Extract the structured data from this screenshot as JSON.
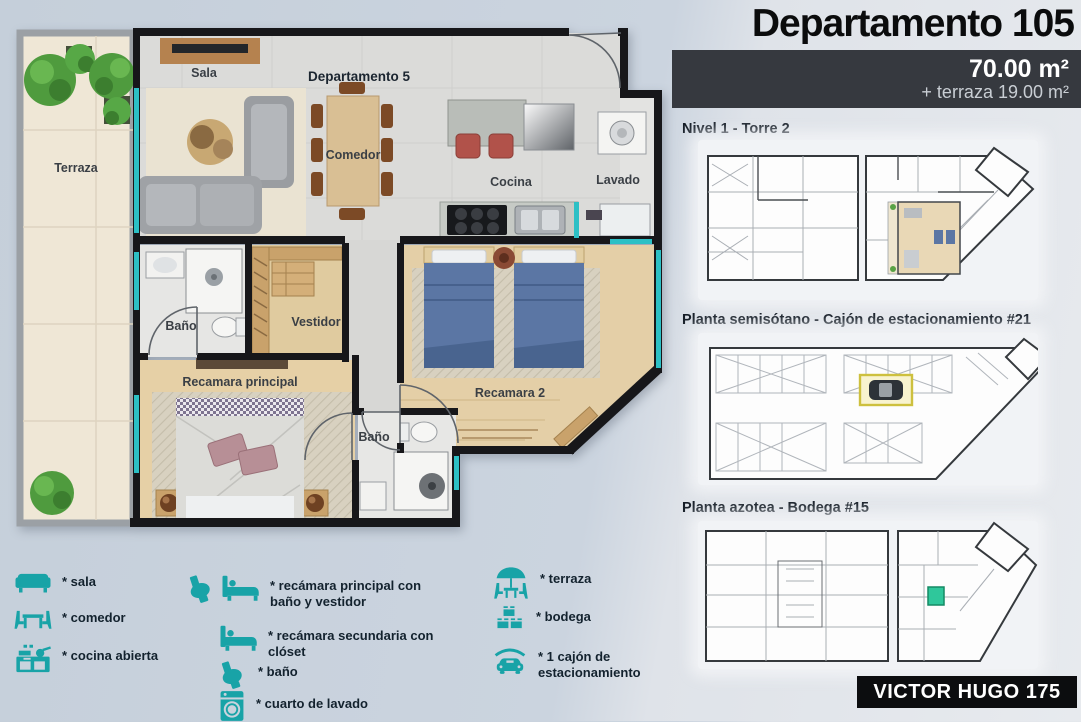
{
  "header": {
    "title": "Departamento 105",
    "area": "70.00 m²",
    "terrace_area": "+ terraza 19.00 m²"
  },
  "sections": {
    "level": {
      "label": "Nivel 1 - Torre 2"
    },
    "basement": {
      "label": "Planta semisótano - Cajón de estacionamiento #21"
    },
    "roof": {
      "label": "Planta azotea - Bodega #15"
    }
  },
  "footer": {
    "brand": "VICTOR HUGO 175"
  },
  "floorplan": {
    "unit_title": "Departamento 5",
    "rooms": {
      "terraza": "Terraza",
      "sala": "Sala",
      "comedor": "Comedor",
      "cocina": "Cocina",
      "lavado": "Lavado",
      "bano_principal": "Baño",
      "vestidor": "Vestidor",
      "recamara_principal": "Recamara principal",
      "recamara_2": "Recamara 2",
      "bano_2": "Baño"
    }
  },
  "legend": {
    "items": [
      {
        "icon": "sofa-icon",
        "label": "* sala"
      },
      {
        "icon": "dining-icon",
        "label": "* comedor"
      },
      {
        "icon": "kitchen-icon",
        "label": "* cocina abierta"
      },
      {
        "icon": "toilet-bed-icon",
        "label": "* recámara principal con baño y vestidor"
      },
      {
        "icon": "bed-icon",
        "label": "* recámara secundaria con clóset"
      },
      {
        "icon": "toilet-icon",
        "label": "* baño"
      },
      {
        "icon": "washer-icon",
        "label": "* cuarto de lavado"
      },
      {
        "icon": "terrace-icon",
        "label": "* terraza"
      },
      {
        "icon": "storage-icon",
        "label": "* bodega"
      },
      {
        "icon": "car-icon",
        "label": "* 1 cajón de estacionamiento"
      }
    ]
  },
  "colors": {
    "accent_teal": "#18a3a7",
    "window_teal": "#2cc0c5",
    "highlight_yellow": "#cdc03e",
    "highlight_green": "#2fc79b",
    "area_box_bg": "#36393f",
    "badge_bg": "#0c0d0f"
  }
}
